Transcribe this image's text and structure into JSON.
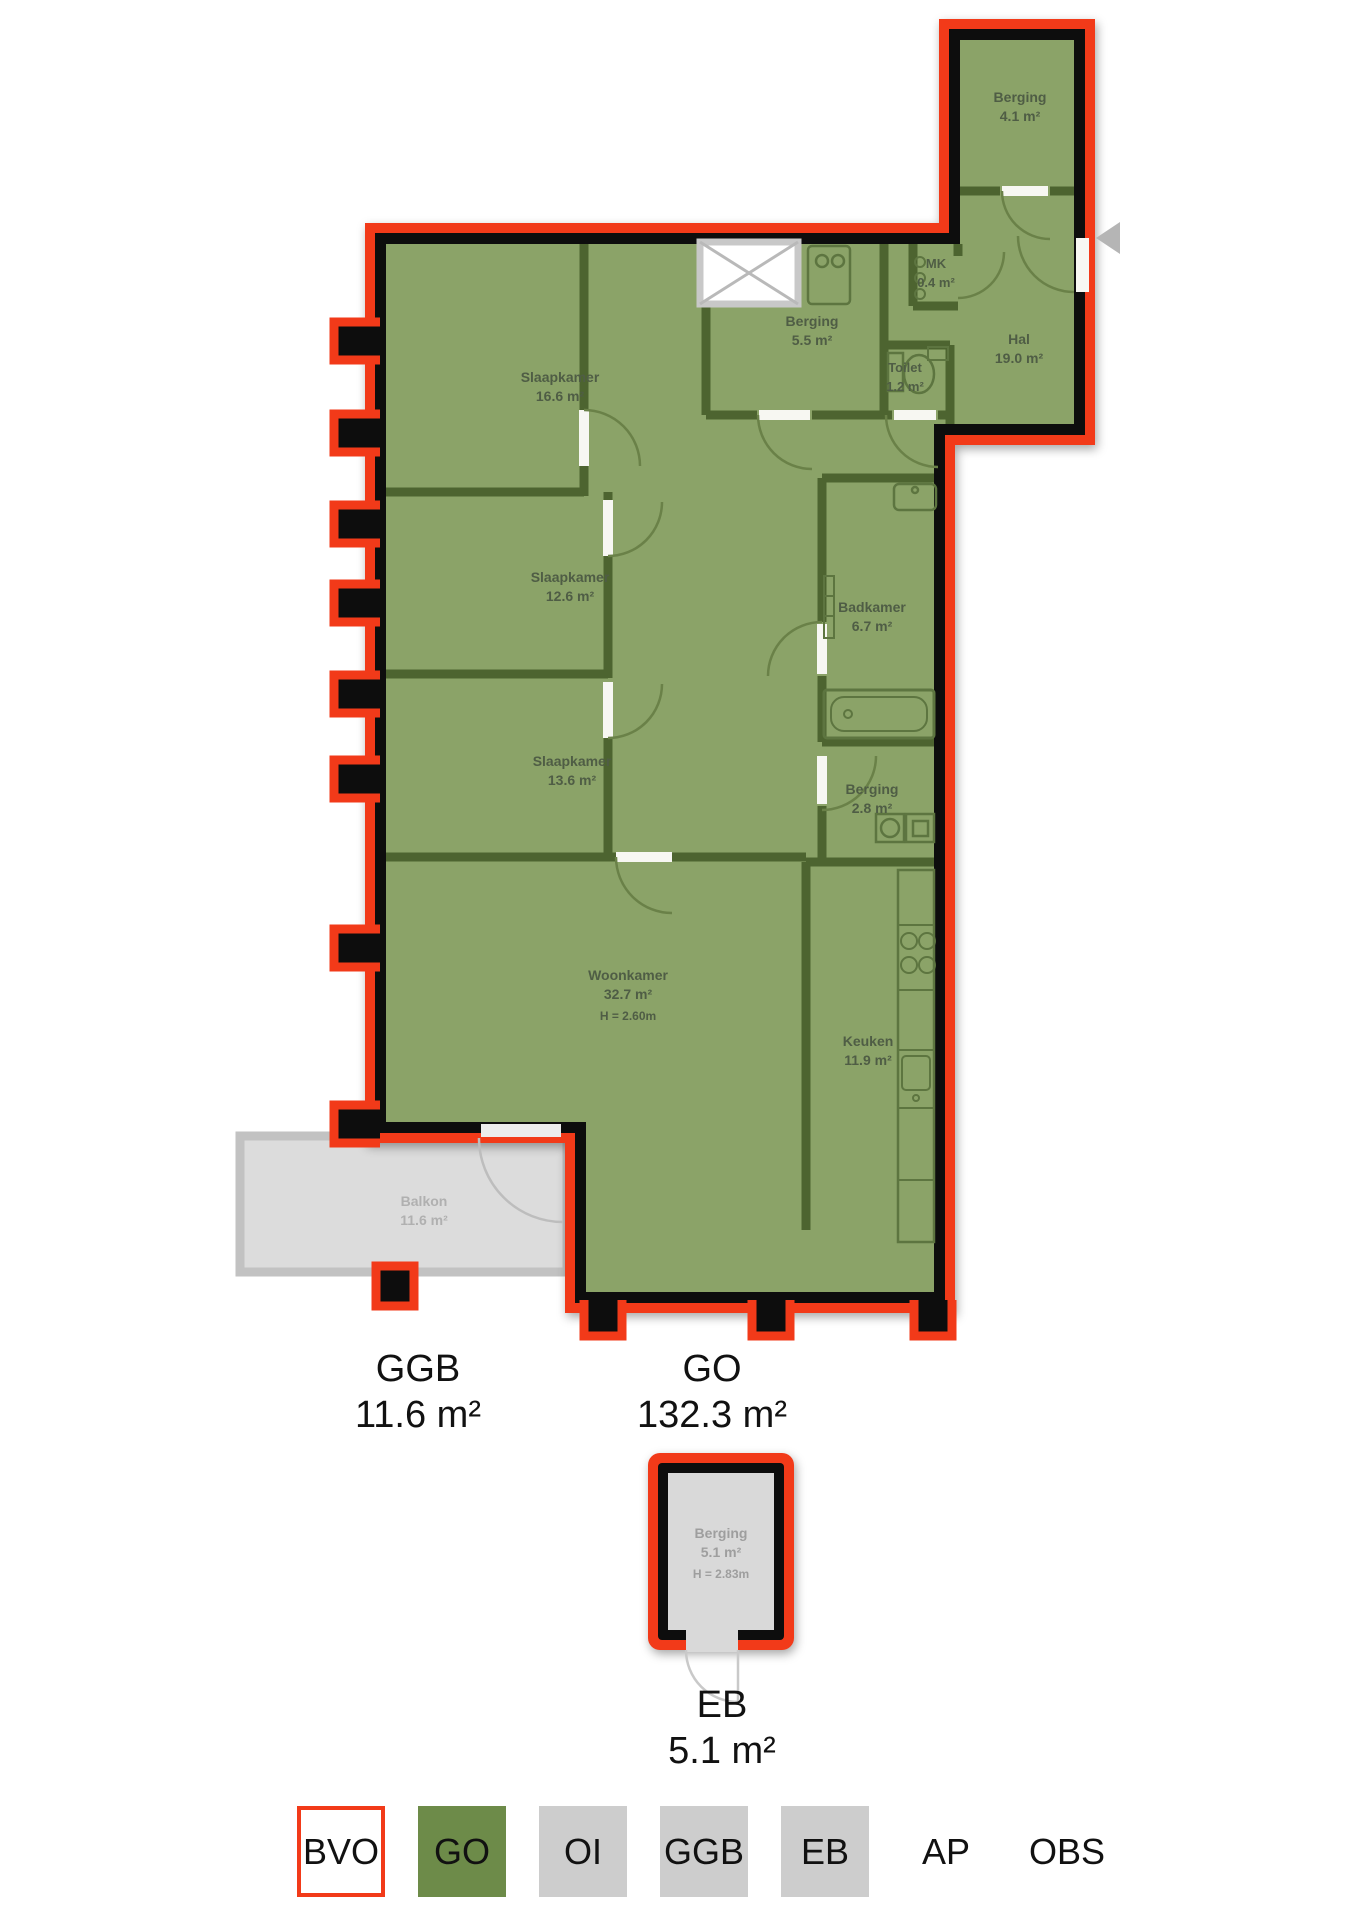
{
  "colors": {
    "bvo_red": "#f23a19",
    "go_green_fill": "#8ba368",
    "go_green_legend": "#6d8b49",
    "interior_wall_green": "#4d6430",
    "wall_black": "#0d0d0d",
    "gray_fill": "#dcdcdc",
    "legend_gray": "#cdcdcd"
  },
  "rooms": {
    "berging_boven": {
      "name": "Berging",
      "area": "4.1 m²"
    },
    "mk": {
      "name": "MK",
      "area": "0.4 m²"
    },
    "hal": {
      "name": "Hal",
      "area": "19.0 m²"
    },
    "berging_midden": {
      "name": "Berging",
      "area": "5.5 m²"
    },
    "toilet": {
      "name": "Toilet",
      "area": "1.2 m²"
    },
    "slaapkamer1": {
      "name": "Slaapkamer",
      "area": "16.6 m²"
    },
    "slaapkamer2": {
      "name": "Slaapkamer",
      "area": "12.6 m²"
    },
    "slaapkamer3": {
      "name": "Slaapkamer",
      "area": "13.6 m²"
    },
    "badkamer": {
      "name": "Badkamer",
      "area": "6.7 m²"
    },
    "berging_klein": {
      "name": "Berging",
      "area": "2.8 m²"
    },
    "woonkamer": {
      "name": "Woonkamer",
      "area": "32.7 m²",
      "height": "H = 2.60m"
    },
    "keuken": {
      "name": "Keuken",
      "area": "11.9 m²"
    },
    "balkon": {
      "name": "Balkon",
      "area": "11.6 m²"
    },
    "externe_berging": {
      "name": "Berging",
      "area": "5.1 m²",
      "height": "H = 2.83m"
    }
  },
  "area_labels": {
    "ggb": {
      "code": "GGB",
      "value": "11.6 m²"
    },
    "go": {
      "code": "GO",
      "value": "132.3 m²"
    },
    "eb": {
      "code": "EB",
      "value": "5.1 m²"
    }
  },
  "legend": {
    "items": [
      {
        "label": "BVO"
      },
      {
        "label": "GO"
      },
      {
        "label": "OI"
      },
      {
        "label": "GGB"
      },
      {
        "label": "EB"
      },
      {
        "label": "AP"
      },
      {
        "label": "OBS"
      }
    ]
  },
  "entrance_indicator": "arrow-left"
}
